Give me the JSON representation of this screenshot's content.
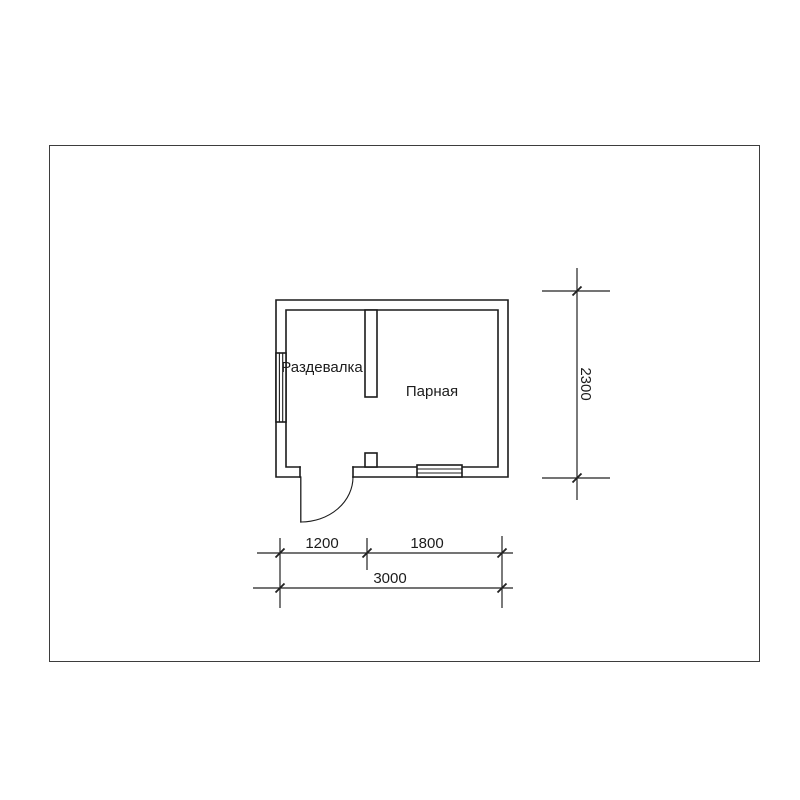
{
  "sheet": {
    "background_color": "#ffffff",
    "border_color": "#3d3d3d"
  },
  "plan": {
    "line_color": "#1c1c1c",
    "dimension_line_color": "#222222",
    "rooms": [
      {
        "label": "Раздевалка"
      },
      {
        "label": "Парная"
      }
    ],
    "dimensions": {
      "bottom_left": "1200",
      "bottom_right": "1800",
      "bottom_total": "3000",
      "side_total": "2300"
    }
  }
}
